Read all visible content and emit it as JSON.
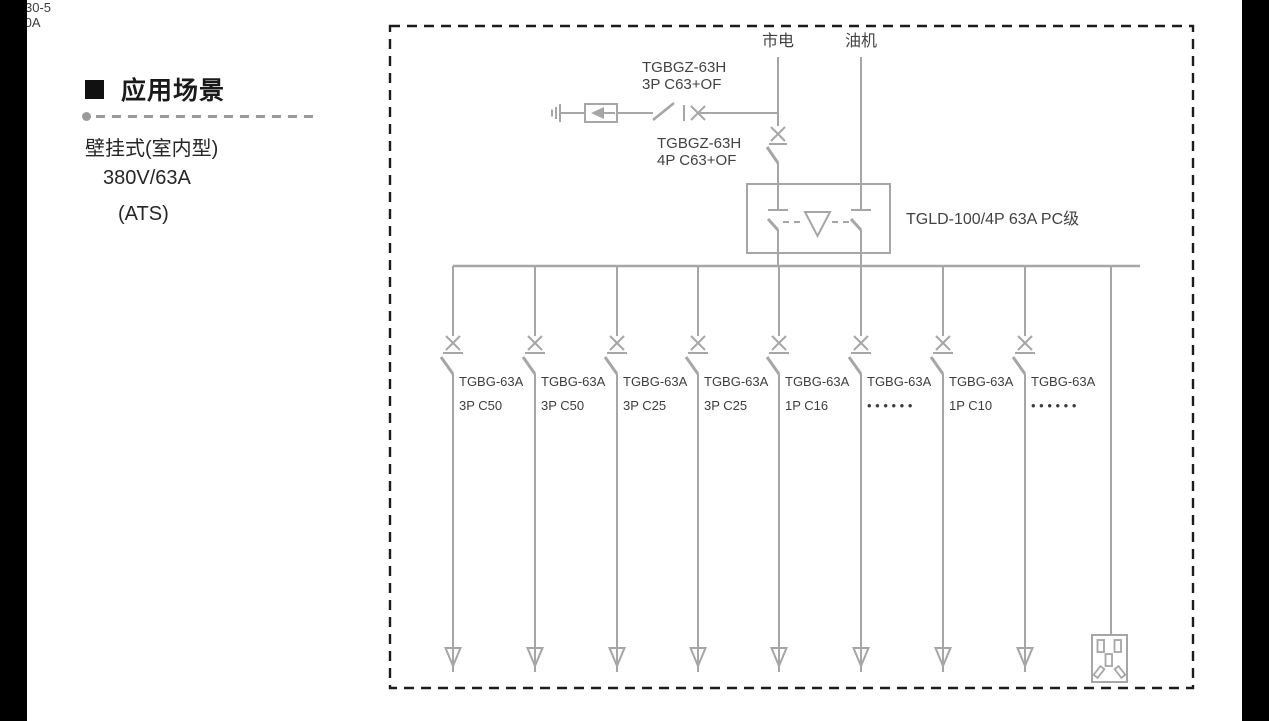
{
  "left_panel": {
    "heading": "应用场景",
    "spec_lines": [
      "壁挂式(室内型)",
      "380V/63A",
      "(ATS)"
    ]
  },
  "diagram": {
    "colors": {
      "line": "#a6a6a6",
      "label": "#424242",
      "border": "#1c1c1c"
    },
    "sources": {
      "mains": "市电",
      "generator": "油机"
    },
    "spd_breaker": {
      "line1": "TGBGZ-63H",
      "line2": "3P C63+OF"
    },
    "main_breaker": {
      "line1": "TGBGZ-63H",
      "line2": "4P C63+OF"
    },
    "ats": {
      "label": "TGLD-100/4P 63A PC级"
    },
    "branches": [
      {
        "line1": "TGBG-63A",
        "line2": "3P C50"
      },
      {
        "line1": "TGBG-63A",
        "line2": "3P C50"
      },
      {
        "line1": "TGBG-63A",
        "line2": "3P C25"
      },
      {
        "line1": "TGBG-63A",
        "line2": "3P C25"
      },
      {
        "line1": "TGBG-63A",
        "line2": "1P C16"
      },
      {
        "line1": "TGBG-63A",
        "line2": "• • • • • •"
      },
      {
        "line1": "TGBG-63A",
        "line2": "1P C10"
      },
      {
        "line1": "TGBG-63A",
        "line2": "• • • • • •"
      }
    ],
    "socket": {
      "line1": "AC30-5",
      "line2": "10A"
    }
  }
}
